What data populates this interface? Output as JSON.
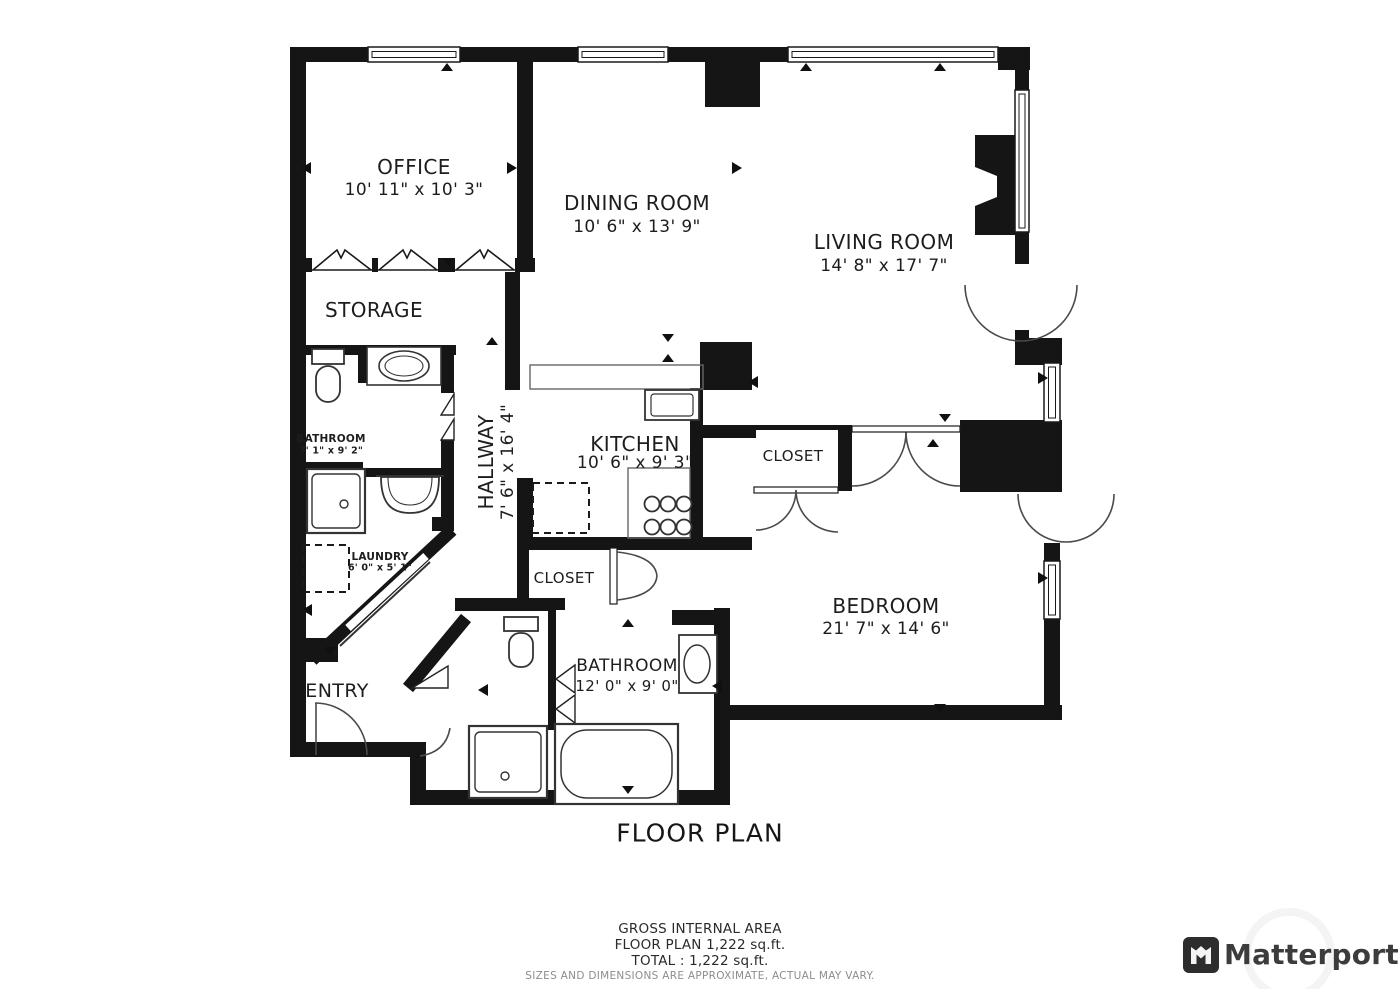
{
  "plan": {
    "title": "FLOOR PLAN",
    "rooms": {
      "office": {
        "name": "OFFICE",
        "dims": "10' 11\" x 10' 3\""
      },
      "dining": {
        "name": "DINING ROOM",
        "dims": "10' 6\" x 13' 9\""
      },
      "living": {
        "name": "LIVING ROOM",
        "dims": "14' 8\" x 17' 7\""
      },
      "storage": {
        "name": "STORAGE"
      },
      "bathroom_up": {
        "name": "BATHROOM",
        "dims": "7' 1\" x 9' 2\""
      },
      "hallway": {
        "name": "HALLWAY",
        "dims": "7' 6\" x 16' 4\""
      },
      "kitchen": {
        "name": "KITCHEN",
        "dims": "10' 6\" x 9' 3\""
      },
      "closet_bed": {
        "name": "CLOSET"
      },
      "closet_hall": {
        "name": "CLOSET"
      },
      "laundry": {
        "name": "LAUNDRY",
        "dims": "6' 0\" x 5' 1\""
      },
      "bedroom": {
        "name": "BEDROOM",
        "dims": "21' 7\" x 14' 6\""
      },
      "bathroom_low": {
        "name": "BATHROOM",
        "dims": "12' 0\" x 9' 0\""
      },
      "entry": {
        "name": "ENTRY"
      }
    },
    "footer": {
      "line1": "GROSS INTERNAL AREA",
      "line2": "FLOOR PLAN 1,222 sq.ft.",
      "line3": "TOTAL :  1,222 sq.ft.",
      "disclaimer": "SIZES AND DIMENSIONS ARE APPROXIMATE, ACTUAL MAY VARY."
    },
    "brand": {
      "name": "Matterport"
    },
    "colors": {
      "wall": "#151515",
      "door_line": "#4a4a4a",
      "text": "#1d1d1d"
    }
  }
}
